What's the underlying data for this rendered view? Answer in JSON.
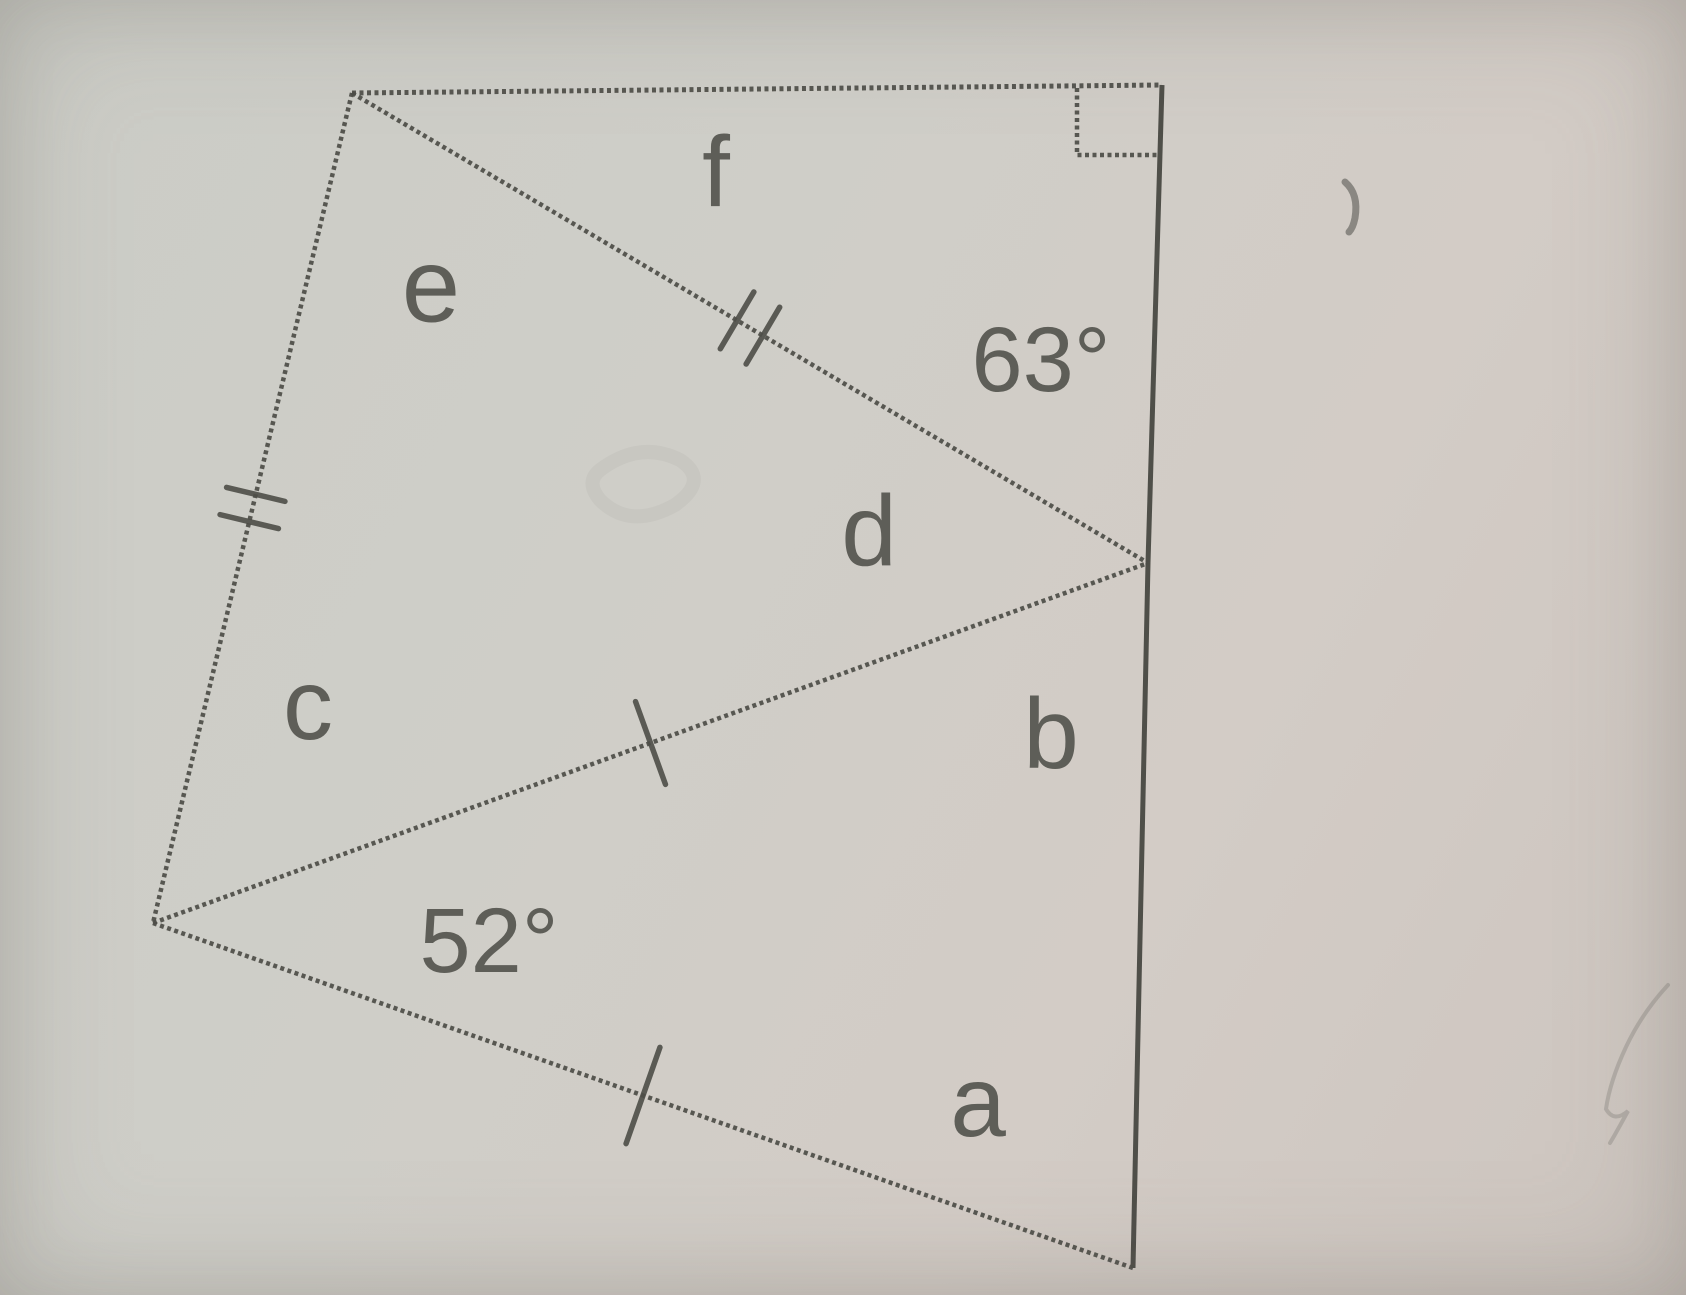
{
  "figure": {
    "description": "Scanned geometry diagram: quadrilateral divided into three triangles by two diagonals, angles labelled a-f",
    "ink_color": "#4e4e48",
    "solid_ink_color": "#45453f",
    "label_color": "#55554f",
    "vertices": {
      "top_left": {
        "x": 352,
        "y": 93
      },
      "top_right": {
        "x": 1162,
        "y": 85
      },
      "right_mid": {
        "x": 1148,
        "y": 563
      },
      "bottom_left": {
        "x": 153,
        "y": 923
      },
      "bottom_right": {
        "x": 1133,
        "y": 1268
      }
    },
    "edges": [
      {
        "name": "top-edge",
        "from": "top_left",
        "to": "top_right",
        "style": "dotted",
        "width": 5,
        "ticks": 0,
        "tick_len": 0,
        "tick_gap": 0
      },
      {
        "name": "right-edge-upper",
        "from": "top_right",
        "to": "right_mid",
        "style": "solid",
        "width": 5,
        "ticks": 0,
        "tick_len": 0,
        "tick_gap": 0
      },
      {
        "name": "right-edge-lower",
        "from": "right_mid",
        "to": "bottom_right",
        "style": "solid",
        "width": 5,
        "ticks": 0,
        "tick_len": 0,
        "tick_gap": 0
      },
      {
        "name": "left-edge",
        "from": "top_left",
        "to": "bottom_left",
        "style": "dotted",
        "width": 4.5,
        "ticks": 2,
        "tick_len": 60,
        "tick_gap": 28
      },
      {
        "name": "diagonal-f",
        "from": "top_left",
        "to": "right_mid",
        "style": "dotted",
        "width": 4.5,
        "ticks": 2,
        "tick_len": 66,
        "tick_gap": 30
      },
      {
        "name": "diagonal-middle",
        "from": "bottom_left",
        "to": "right_mid",
        "style": "dotted",
        "width": 4.5,
        "ticks": 1,
        "tick_len": 88,
        "tick_gap": 0
      },
      {
        "name": "bottom-edge",
        "from": "bottom_left",
        "to": "bottom_right",
        "style": "dotted",
        "width": 4.5,
        "ticks": 1,
        "tick_len": 102,
        "tick_gap": 0
      }
    ],
    "right_angle_marker": {
      "corner": "top_right",
      "x": 1077,
      "y": 155,
      "size_x": 83,
      "size_y": 67
    },
    "labels": [
      {
        "id": "angle-label-f",
        "text": "f",
        "x": 716,
        "y": 172,
        "size": 100
      },
      {
        "id": "angle-label-e",
        "text": "e",
        "x": 431,
        "y": 286,
        "size": 105
      },
      {
        "id": "angle-value-63",
        "text": "63°",
        "x": 1041,
        "y": 360,
        "size": 92
      },
      {
        "id": "angle-label-d",
        "text": "d",
        "x": 869,
        "y": 531,
        "size": 100
      },
      {
        "id": "angle-label-c",
        "text": "c",
        "x": 308,
        "y": 705,
        "size": 100
      },
      {
        "id": "angle-label-b",
        "text": "b",
        "x": 1051,
        "y": 734,
        "size": 100
      },
      {
        "id": "angle-value-52",
        "text": "52°",
        "x": 489,
        "y": 941,
        "size": 92
      },
      {
        "id": "angle-label-a",
        "text": "a",
        "x": 978,
        "y": 1102,
        "size": 100
      }
    ],
    "smudges": [
      {
        "name": "pencil-smudge-top-right",
        "path": "M 1345 182 q 14 12 10 36 q -2 10 -6 14",
        "width": 7,
        "opacity": 0.55
      },
      {
        "name": "pencil-smudge-right-side",
        "path": "M 1668 985 q -26 28 -42 62 q -16 34 -20 62 q 8 14 22 2 q -12 22 -18 32",
        "width": 4,
        "opacity": 0.22
      },
      {
        "name": "bleed-through-ghost",
        "path": "M 600 470 q 40 -30 80 -10 q 30 20 -5 45 q -45 25 -75 -5 q -15 -18 0 -30",
        "width": 14,
        "opacity": 0.05
      }
    ]
  }
}
